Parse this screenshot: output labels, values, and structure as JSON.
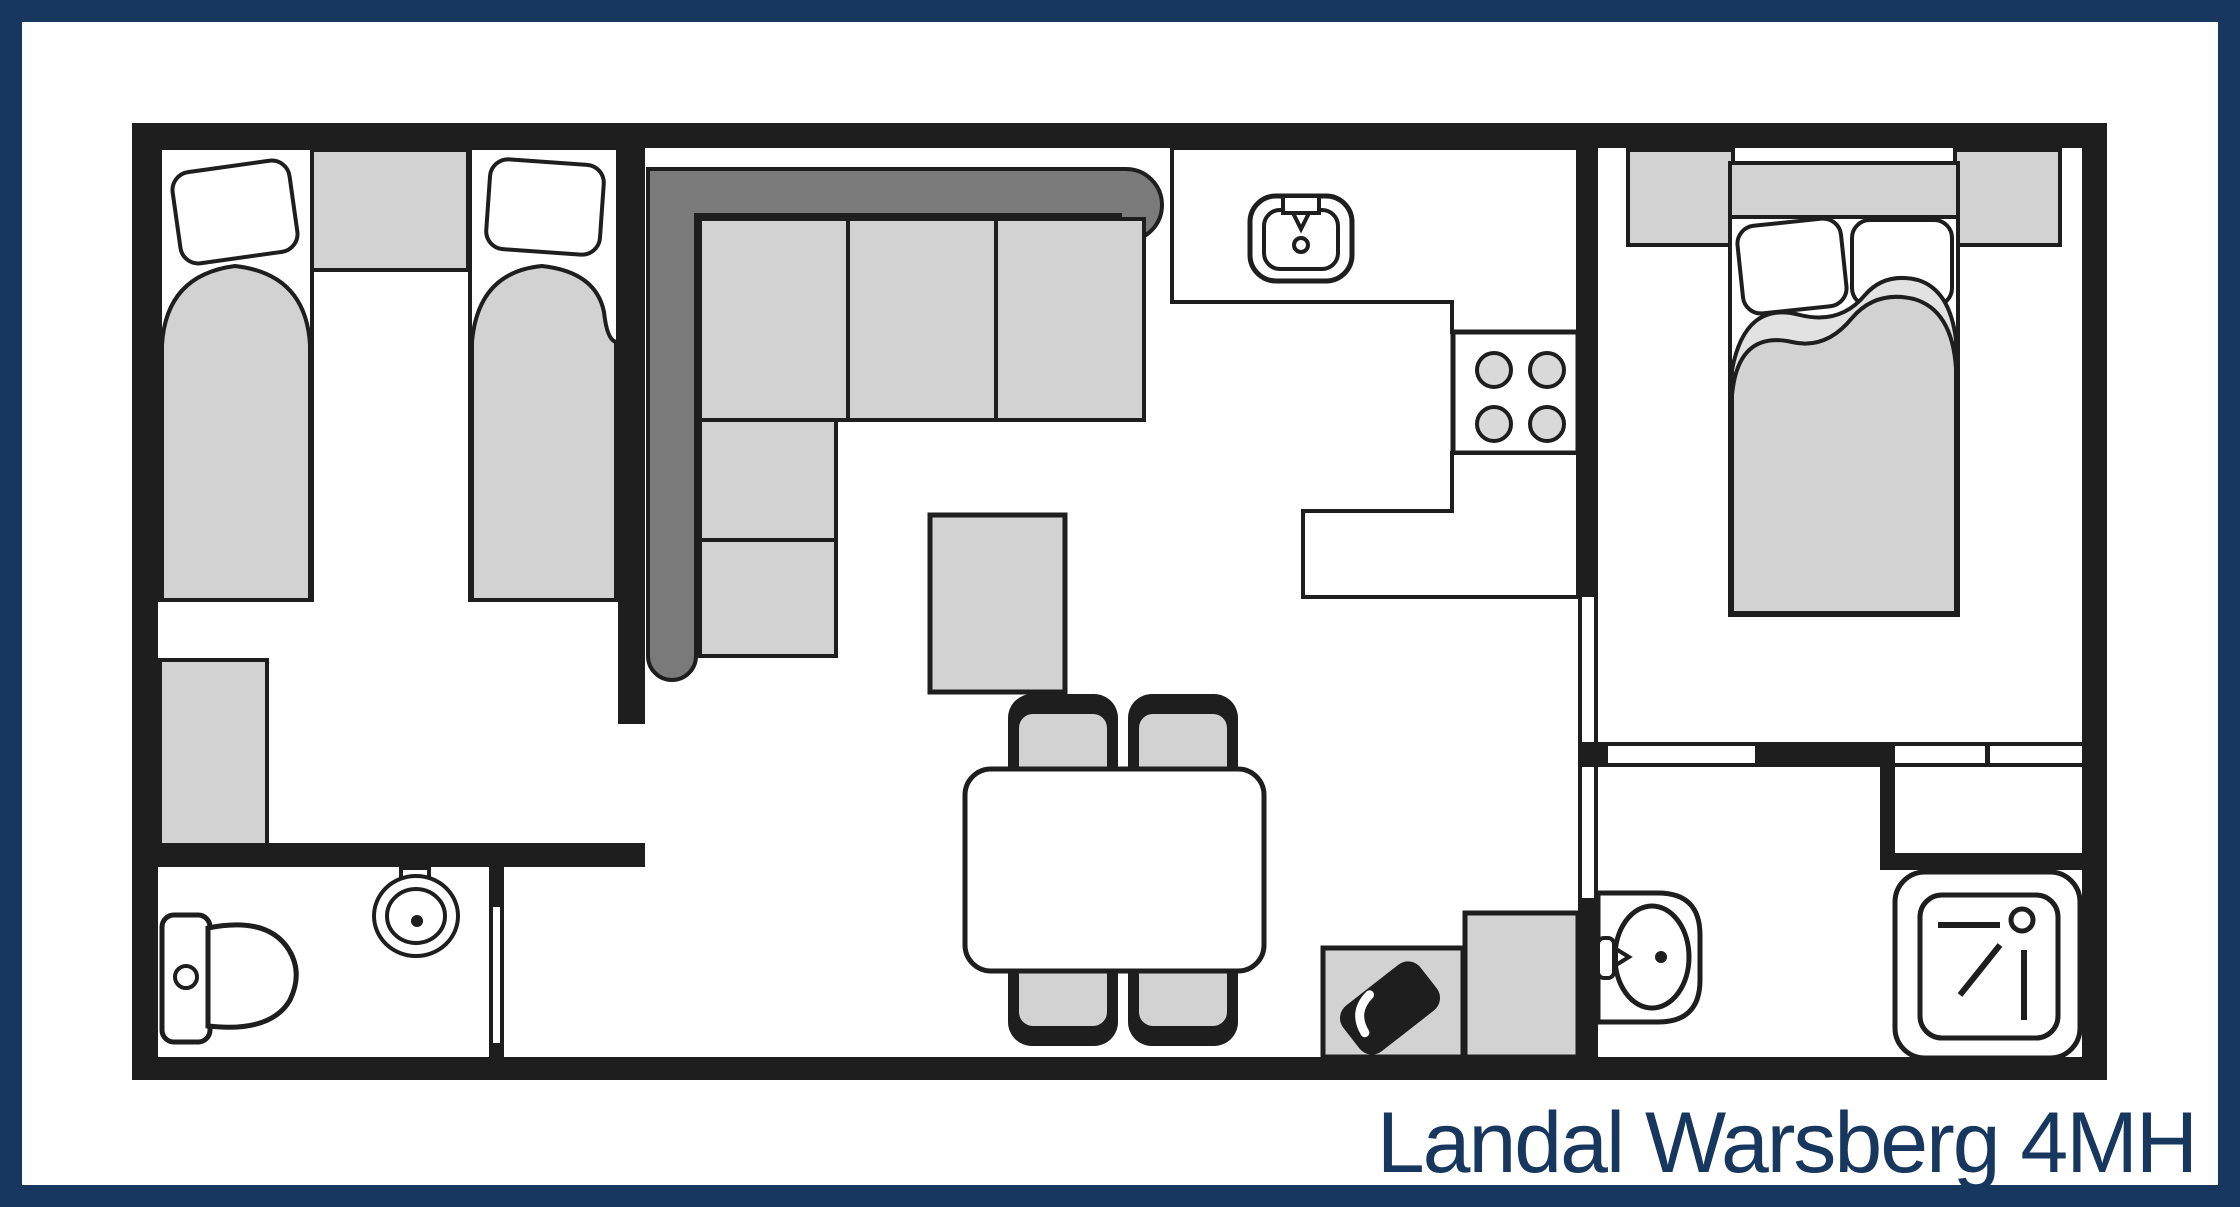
{
  "title": {
    "label": "Landal Warsberg 4MH"
  },
  "colors": {
    "frame": "#17375E",
    "text": "#17375E",
    "wall": "#1E1E1E",
    "furniture_light": "#D2D2D2",
    "furniture_fold": "#E2E2E2",
    "sofa_back": "#7A7A7A",
    "burner": "#D9D9D9",
    "background": "#FFFFFF"
  }
}
